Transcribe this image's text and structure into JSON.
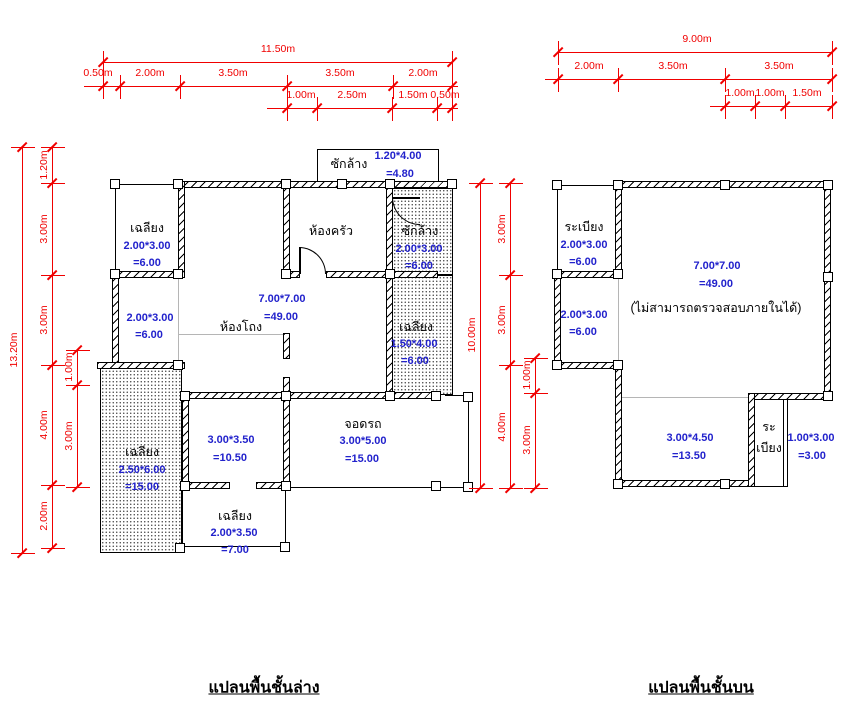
{
  "page": {
    "background": "#ffffff"
  },
  "colors": {
    "dimension": "#f00000",
    "area_text": "#2222cc",
    "label_text": "#000000"
  },
  "plans": {
    "ground": {
      "title": "แปลนพื้นชั้นล่าง",
      "texts": [
        {
          "t": "เฉลียง",
          "x": 147,
          "y": 228,
          "c": "k"
        },
        {
          "t": "2.00*3.00",
          "x": 147,
          "y": 246,
          "c": "b"
        },
        {
          "t": "=6.00",
          "x": 147,
          "y": 263,
          "c": "b"
        },
        {
          "t": "ซักล้าง",
          "x": 349,
          "y": 164,
          "c": "k"
        },
        {
          "t": "1.20*4.00",
          "x": 398,
          "y": 156,
          "c": "b"
        },
        {
          "t": "=4.80",
          "x": 400,
          "y": 174,
          "c": "b"
        },
        {
          "t": "ห้องครัว",
          "x": 331,
          "y": 231,
          "c": "k"
        },
        {
          "t": "ซักล้าง",
          "x": 420,
          "y": 231,
          "c": "k"
        },
        {
          "t": "2.00*3.00",
          "x": 419,
          "y": 249,
          "c": "b"
        },
        {
          "t": "=6.00",
          "x": 419,
          "y": 266,
          "c": "b"
        },
        {
          "t": "2.00*3.00",
          "x": 150,
          "y": 318,
          "c": "b"
        },
        {
          "t": "=6.00",
          "x": 149,
          "y": 335,
          "c": "b"
        },
        {
          "t": "7.00*7.00",
          "x": 282,
          "y": 299,
          "c": "b"
        },
        {
          "t": "=49.00",
          "x": 281,
          "y": 317,
          "c": "b"
        },
        {
          "t": "ห้องโถง",
          "x": 241,
          "y": 327,
          "c": "k"
        },
        {
          "t": "เฉลียง",
          "x": 416,
          "y": 327,
          "c": "k"
        },
        {
          "t": "1.50*4.00",
          "x": 414,
          "y": 344,
          "c": "b"
        },
        {
          "t": "=6.00",
          "x": 415,
          "y": 361,
          "c": "b"
        },
        {
          "t": "เฉลียง",
          "x": 142,
          "y": 452,
          "c": "k"
        },
        {
          "t": "2.50*6.00",
          "x": 142,
          "y": 470,
          "c": "b"
        },
        {
          "t": "=15.00",
          "x": 142,
          "y": 487,
          "c": "b"
        },
        {
          "t": "3.00*3.50",
          "x": 231,
          "y": 440,
          "c": "b"
        },
        {
          "t": "=10.50",
          "x": 230,
          "y": 458,
          "c": "b"
        },
        {
          "t": "จอดรถ",
          "x": 363,
          "y": 424,
          "c": "k"
        },
        {
          "t": "3.00*5.00",
          "x": 363,
          "y": 441,
          "c": "b"
        },
        {
          "t": "=15.00",
          "x": 362,
          "y": 459,
          "c": "b"
        },
        {
          "t": "เฉลียง",
          "x": 235,
          "y": 516,
          "c": "k"
        },
        {
          "t": "2.00*3.50",
          "x": 234,
          "y": 533,
          "c": "b"
        },
        {
          "t": "=7.00",
          "x": 235,
          "y": 550,
          "c": "b"
        }
      ]
    },
    "upper": {
      "title": "แปลนพื้นชั้นบน",
      "texts": [
        {
          "t": "ระเบียง",
          "x": 584,
          "y": 227,
          "c": "k"
        },
        {
          "t": "2.00*3.00",
          "x": 584,
          "y": 245,
          "c": "b"
        },
        {
          "t": "=6.00",
          "x": 583,
          "y": 262,
          "c": "b"
        },
        {
          "t": "2.00*3.00",
          "x": 584,
          "y": 315,
          "c": "b"
        },
        {
          "t": "=6.00",
          "x": 583,
          "y": 332,
          "c": "b"
        },
        {
          "t": "7.00*7.00",
          "x": 717,
          "y": 266,
          "c": "b"
        },
        {
          "t": "=49.00",
          "x": 716,
          "y": 284,
          "c": "b"
        },
        {
          "t": "(ไม่สามารถตรวจสอบภายในได้)",
          "x": 716,
          "y": 308,
          "c": "k"
        },
        {
          "t": "3.00*4.50",
          "x": 690,
          "y": 438,
          "c": "b"
        },
        {
          "t": "=13.50",
          "x": 689,
          "y": 456,
          "c": "b"
        },
        {
          "t": "ระ",
          "x": 769,
          "y": 427,
          "c": "k"
        },
        {
          "t": "เบียง",
          "x": 769,
          "y": 448,
          "c": "k"
        },
        {
          "t": "1.00*3.00",
          "x": 811,
          "y": 438,
          "c": "b"
        },
        {
          "t": "=3.00",
          "x": 812,
          "y": 456,
          "c": "b"
        }
      ]
    }
  },
  "dimensions": [
    {
      "orient": "h",
      "pos": 62,
      "from": 103,
      "to": 452,
      "ticks": [
        103,
        452
      ],
      "labels": [
        {
          "text": "11.50m",
          "at": 278
        }
      ]
    },
    {
      "orient": "h",
      "pos": 86,
      "from": 84,
      "to": 458,
      "ticks": [
        103,
        120,
        180,
        287,
        393,
        452
      ],
      "labels": [
        {
          "text": "0.50m",
          "at": 98
        },
        {
          "text": "2.00m",
          "at": 150
        },
        {
          "text": "3.50m",
          "at": 233
        },
        {
          "text": "3.50m",
          "at": 340
        },
        {
          "text": "2.00m",
          "at": 423
        }
      ]
    },
    {
      "orient": "h",
      "pos": 108,
      "from": 267,
      "to": 458,
      "ticks": [
        287,
        317,
        392,
        437,
        452
      ],
      "labels": [
        {
          "text": "1.00m",
          "at": 301
        },
        {
          "text": "2.50m",
          "at": 352
        },
        {
          "text": "1.50m",
          "at": 413
        },
        {
          "text": "0.50m",
          "at": 445
        }
      ]
    },
    {
      "orient": "h",
      "pos": 52,
      "from": 558,
      "to": 832,
      "ticks": [
        558,
        832
      ],
      "labels": [
        {
          "text": "9.00m",
          "at": 697
        }
      ]
    },
    {
      "orient": "h",
      "pos": 79,
      "from": 545,
      "to": 832,
      "ticks": [
        558,
        618,
        725,
        832
      ],
      "labels": [
        {
          "text": "2.00m",
          "at": 589
        },
        {
          "text": "3.50m",
          "at": 673
        },
        {
          "text": "3.50m",
          "at": 779
        }
      ]
    },
    {
      "orient": "h",
      "pos": 106,
      "from": 710,
      "to": 832,
      "ticks": [
        725,
        755,
        785,
        832
      ],
      "labels": [
        {
          "text": "1.00m",
          "at": 740
        },
        {
          "text": "1.00m",
          "at": 770
        },
        {
          "text": "1.50m",
          "at": 807
        }
      ]
    },
    {
      "orient": "v",
      "pos": 22,
      "from": 147,
      "to": 553,
      "ticks": [
        147,
        553
      ],
      "labels": [
        {
          "text": "13.20m",
          "at": 350
        }
      ]
    },
    {
      "orient": "v",
      "pos": 52,
      "from": 147,
      "to": 548,
      "ticks": [
        147,
        183,
        275,
        365,
        485,
        548
      ],
      "labels": [
        {
          "text": "1.20m",
          "at": 165
        },
        {
          "text": "3.00m",
          "at": 229
        },
        {
          "text": "3.00m",
          "at": 320
        },
        {
          "text": "4.00m",
          "at": 425
        },
        {
          "text": "2.00m",
          "at": 516
        }
      ]
    },
    {
      "orient": "v",
      "pos": 77,
      "from": 350,
      "to": 487,
      "ticks": [
        350,
        385,
        487
      ],
      "labels": [
        {
          "text": "1.00m",
          "at": 367
        },
        {
          "text": "3.00m",
          "at": 436
        }
      ]
    },
    {
      "orient": "v",
      "pos": 480,
      "from": 183,
      "to": 488,
      "ticks": [
        183,
        488
      ],
      "labels": [
        {
          "text": "10.00m",
          "at": 335
        }
      ]
    },
    {
      "orient": "v",
      "pos": 510,
      "from": 183,
      "to": 488,
      "ticks": [
        183,
        275,
        365,
        488
      ],
      "labels": [
        {
          "text": "3.00m",
          "at": 229
        },
        {
          "text": "3.00m",
          "at": 320
        },
        {
          "text": "4.00m",
          "at": 427
        }
      ]
    },
    {
      "orient": "v",
      "pos": 535,
      "from": 358,
      "to": 488,
      "ticks": [
        358,
        393,
        488
      ],
      "labels": [
        {
          "text": "1.00m",
          "at": 375
        },
        {
          "text": "3.00m",
          "at": 440
        }
      ]
    }
  ]
}
